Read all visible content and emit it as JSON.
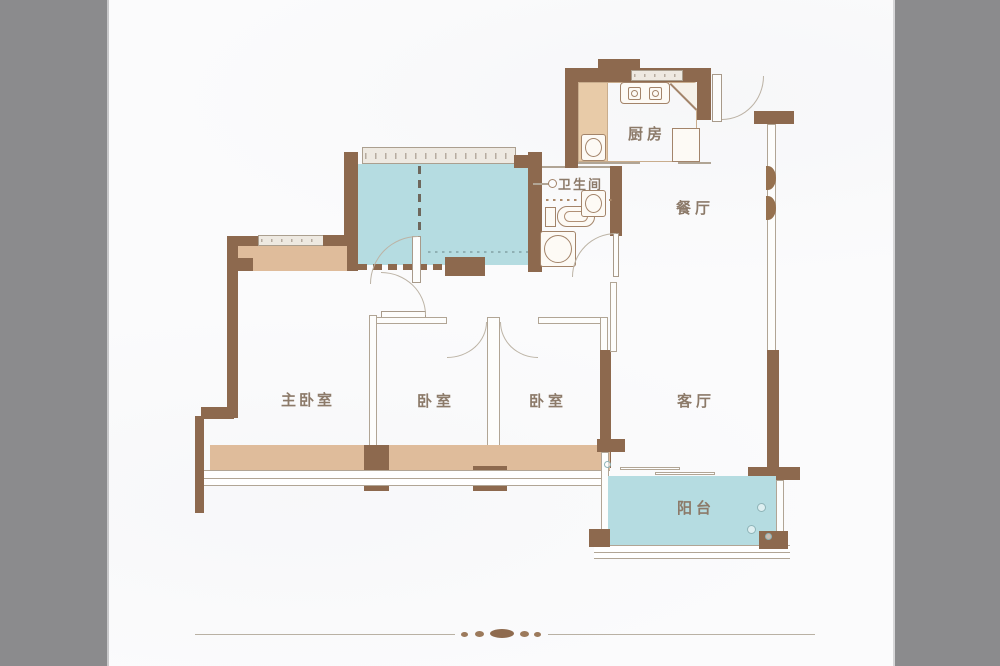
{
  "page": {
    "background": "#fbfbfc",
    "side_panels": {
      "color": "#8b8b8d",
      "left_width_px": 107,
      "right_width_px": 107
    }
  },
  "palette": {
    "wall_brown": "#8d694e",
    "bay_window_tan": "#dfbc9b",
    "highlight_teal": "#b5dce1",
    "thin_wall_line": "#b1a595",
    "label_text": "#8c7a69",
    "ornament_brown": "#8f6b4f"
  },
  "rooms": {
    "kitchen": {
      "label": "厨房"
    },
    "bathroom": {
      "label": "卫生间"
    },
    "dining_room": {
      "label": "餐厅"
    },
    "master_bedroom": {
      "label": "主卧室"
    },
    "bedroom_left": {
      "label": "卧室"
    },
    "bedroom_right": {
      "label": "卧室"
    },
    "living_room": {
      "label": "客厅"
    },
    "balcony": {
      "label": "阳台"
    }
  },
  "fixtures": [
    "stove-icon",
    "kitchen-sink-icon",
    "fridge-icon",
    "corner-cabinet-icon",
    "shower-head-icon",
    "toilet-icon",
    "wash-basin-icon"
  ]
}
